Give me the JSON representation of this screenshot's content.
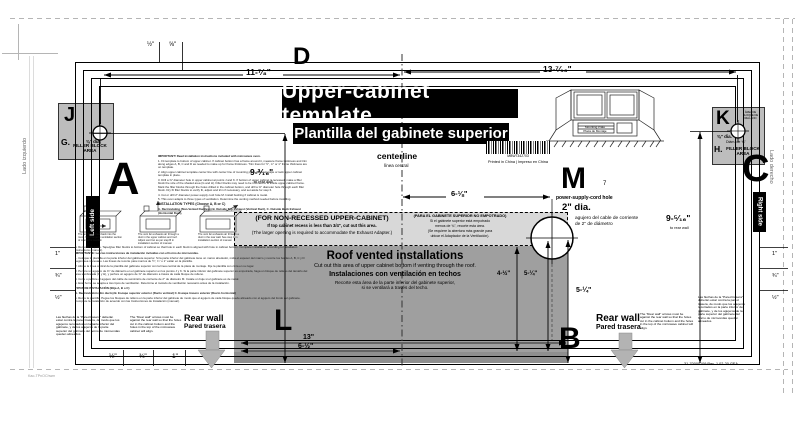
{
  "doc": {
    "title": "Upper-cabinet template",
    "subtitle": "Plantilla del gabinete superior",
    "centerline": "centerline",
    "centerline_es": "línea central",
    "barcode_number": "MBW7342703",
    "printed": "Printed in China | Impreso en China",
    "part_footer": "31-70000109   Rev. 1   02-20   GEA",
    "corner_note": "Kao-TPnOChwm"
  },
  "edges": {
    "top": "D",
    "left": "A",
    "right": "C",
    "bottom": "B"
  },
  "side_labels": {
    "left_box": "Left side",
    "right_box": "Right side",
    "left_es": "Lado izquierdo",
    "right_es": "Lado derecho"
  },
  "holes": {
    "j": {
      "letter": "J",
      "dia": "⅜\" dia.",
      "block_letter": "G.",
      "block_label": "FILLER BLOCK AREA"
    },
    "k": {
      "letter": "K",
      "area_es": "ÁREA DE BLOQUE DE RELLENO",
      "dia": "⅜\" dia.",
      "dia_es": "Diám. de ⅜\"",
      "block_letter": "H.",
      "block_label": "FILLER BLOCK AREA"
    },
    "m": {
      "letter": "M",
      "step": "7",
      "label": "power-supply-cord hole",
      "dia": "2\" dia.",
      "dia_es_1": "agujero del cable de corriente",
      "dia_es_2": "de 2\" de diámetro"
    }
  },
  "dims": {
    "d11": "11-⁷⁄₈\"",
    "d13_7": "13-⁷⁄₁₆\"",
    "d9l": "9-³⁄₁₆\"",
    "d9l_note": "to rear wall",
    "d9r": "9-⁵⁄₁₆\"",
    "d9r_note": "to rear wall",
    "d6": "6-⅛\"",
    "d45": "4-½\"",
    "d525a": "5-¼\"",
    "d525b": "5-¼\"",
    "d13": "13\"",
    "d65": "6-½\"",
    "top_marks": [
      "½\"",
      "⅝\""
    ],
    "bottom_marks": [
      "½\"",
      "¾\"",
      "1\""
    ],
    "right_marks": [
      "1\"",
      "¾\"",
      "½\""
    ],
    "left_marks": [
      "1\"",
      "¾\"",
      "½\""
    ]
  },
  "strip": {
    "en_title": "(FOR NON-RECESSED UPPER-CABINET)",
    "en_1": "If top cabinet recess is less than 3/4\", cut out this area.",
    "en_2": "(The larger opening is required to accommodate the Exhaust Adapter.)",
    "es_title": "(PARA EL GABINETE SUPERIOR NO EMPOTRADO)",
    "es_1": "Si el gabinete superior está empotrado",
    "es_2": "menos de ¾\", recorte esta área.",
    "es_3": "(Se requiere la abertura más grande para",
    "es_4": "ubicar el Adaptador de la Ventilación)."
  },
  "roof": {
    "letter": "L",
    "title": "Roof vented  installations",
    "en": "Cut out this area of upper cabinet bottom  if venting through the roof.",
    "es_title": "Instalaciones con ventilación en techos",
    "es_1": "Recorte esta área de la parte inferior del gabinete superior,",
    "es_2": "si se ventilará a través del techo."
  },
  "rear_wall": {
    "en": "Rear wall",
    "es": "Pared trasera",
    "note_en": "The \"Rear wall\" arrows must be against the rear wall so that the holes cut in the cabinet bottom and the holes in the top of the microwave cabinet will align.",
    "note_es": "Las flechas de la \"Pared trasera\" deberán estar contra la pared trasera, de modo que los agujeros recortados en la parte inferior del gabinete, y de los agujeros de la parte superior del gabinete del horno de microondas queden alineados."
  },
  "illustration": {
    "label1": "Mounting Plate",
    "label2": "Placa de Montaje"
  },
  "instructions": {
    "important": "IMPORTANT! Read installation instructions included with microwave oven.",
    "s1": "1. Fit template to bottom of upper cabinet. If cabinet bottom has a frame around it, measure frame thickness and trim along edges A, B, C and D as needed to make up for frame thickness. Trim lines for ½\", ¾\" or 1\" frame thickness are on template.",
    "s2": "2. Align upper cabinet template center line with center line of mounting plate. Securely tape or tack upper cabinet template in place.",
    "s3": "3. Drill a ⅜\" diameter hole in upper cabinet at points J and K. If bottom of upper cabinet is recessed, make a filler block the size of the shaded area (G and H). Filler blocks may need to be trimmed to fit inside upper cabinet frame. Mark the filler blocks through the holes drilled in the cabinet bottom, and drill a ⅜\" diameter hole through each filler block. Dry fit filler blocks to verify fit, adjust and trim if necessary, and set aside for step 6.",
    "s4": "4. Cut or drill 2\" diameter power-supply cord hole M. Install bushing if cabinet is metal.",
    "s5": "5. This oven adapts to three types of ventilation. Determine the venting method needed before installing.",
    "types_title": "INSTALLATION TYPES (Choose A, B or C)",
    "types": "A. Recirculating (Non-Vented Ductless)     B. Outside Top Exhaust (Vertical Duct),     C. Outside Back Exhaust (Horizontal Duct),",
    "cap_a": "The unit blows heat back into the room. No change in ventilation section of manual is needed.",
    "cap_b": "The vent fan exhausts air through a duct in the upper cabinet and roof. Adjust vent fan as per step B in installation section of manual.",
    "cap_c": "The vent fan exhausts air through a duct in the rear wall. See step C in installation section of manual.",
    "s6": "6. Remove template. Tape/glue filler blocks to bottom of cabinet so that hole in each block is aligned with hole in cabinet bottom. Complete installation according to Installation Instructions (manual).",
    "es_importante": "IMPORTANTE: Lea las instrucciones de instalación incluidas con el horno de microondas.",
    "es_s1": "1. Coloque la plantilla en la parte inferior del gabinete superior. Si la parte inferior del gabinete tiene un marco alrededor, mida el espesor del marco y recorte los bordes A, B, C y D según sea necesario. Las líneas de recorte para marcos de ½\", ¾\" o 1\" están en la plantilla.",
    "es_s2": "2. Alinee la línea central de la plantilla del gabinete superior con la línea central de la placa de montaje. Fije la plantilla con cinta en su lugar.",
    "es_s3": "3. Perfore un agujero de ⅜\" de diámetro en el gabinete superior en los puntos J y K. Si la parte inferior del gabinete superior es empotrada, haga un bloque de relleno del tamaño del área sombreada (G y H), y perfore un agujero de ⅜\" de diámetro a través de cada bloque de relleno.",
    "es_s4": "4. Corte o perfore el agujero del cable de suministro de corriente de 2\" de diámetro M. Instale un buje si el gabinete es de metal.",
    "es_s5": "5. Este horno se adapta a tres tipos de ventilación. Determine el método de ventilación necesario antes de la instalación.",
    "es_tipos_title": "TIPOS DE INSTALACIÓN (Elija A, B o C)",
    "es_tipos": "A. Recirculación (Sin ducto)     B. Escape superior exterior (Ducto vertical)     C. Escape trasero exterior (Ducto horizontal)",
    "es_s6": "6. Retire la plantilla. Pegue los bloques de relleno en la parte inferior del gabinete de modo que el agujero de cada bloque quede alineado con el agujero del fondo del gabinete. Complete la instalación de acuerdo con las Instrucciones de Instalación (manual)."
  }
}
